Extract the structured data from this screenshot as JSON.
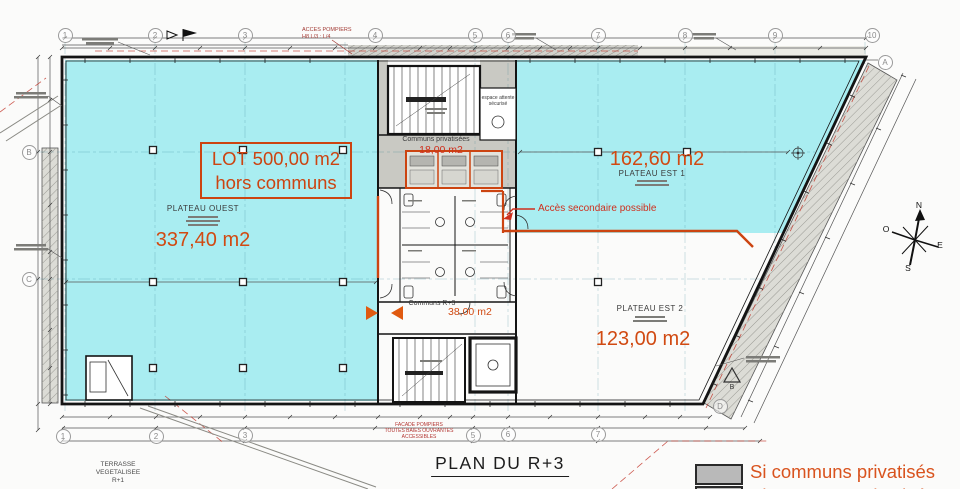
{
  "title": "PLAN DU R+3",
  "lot_box": {
    "line1": "LOT 500,00 m2",
    "line2": "hors communs"
  },
  "plateaus": {
    "ouest": {
      "name": "PLATEAU OUEST",
      "area": "337,40 m2"
    },
    "est1": {
      "name": "PLATEAU EST 1",
      "area": "162,60 m2"
    },
    "est2": {
      "name": "PLATEAU EST 2",
      "area": "123,00 m2"
    },
    "communs_privatises": {
      "name": "Communs privatisées",
      "area": "18,00 m2"
    },
    "communs_r3": {
      "name": "Communs R+3",
      "area": "38,00 m2"
    }
  },
  "annotations": {
    "acces_secondaire": "Accès secondaire possible",
    "acces_pompiers_1": "ACCES POMPIERS",
    "acces_pompiers_2": "H8 L/3 : L/4",
    "facade_pompiers_1": "FACADE POMPIERS",
    "facade_pompiers_2": "TOUTES BAIES OUVRANTES",
    "facade_pompiers_3": "ACCESSIBLES",
    "terrasse_1": "TERRASSE",
    "terrasse_2": "VEGETALISEE",
    "terrasse_3": "R+1",
    "espace_attente_1": "espace attente",
    "espace_attente_2": "sécurisé"
  },
  "legend": {
    "label": "Si communs privatisés"
  },
  "compass": {
    "n": "N",
    "s": "S",
    "e": "E",
    "o": "O"
  },
  "grid": {
    "top": [
      "1",
      "2",
      "3",
      "4",
      "5",
      "6",
      "7",
      "8",
      "9",
      "10"
    ],
    "bottom": [
      "1",
      "2",
      "3",
      "5",
      "6",
      "7"
    ],
    "left": [
      "B",
      "C"
    ],
    "right_a": "A",
    "right_d": "D",
    "triangle_b": "B"
  },
  "colors": {
    "highlight": "#a9edf1",
    "accent": "#d14a12",
    "red": "#cf2f1d",
    "gray_fill": "#c9c9c3"
  }
}
